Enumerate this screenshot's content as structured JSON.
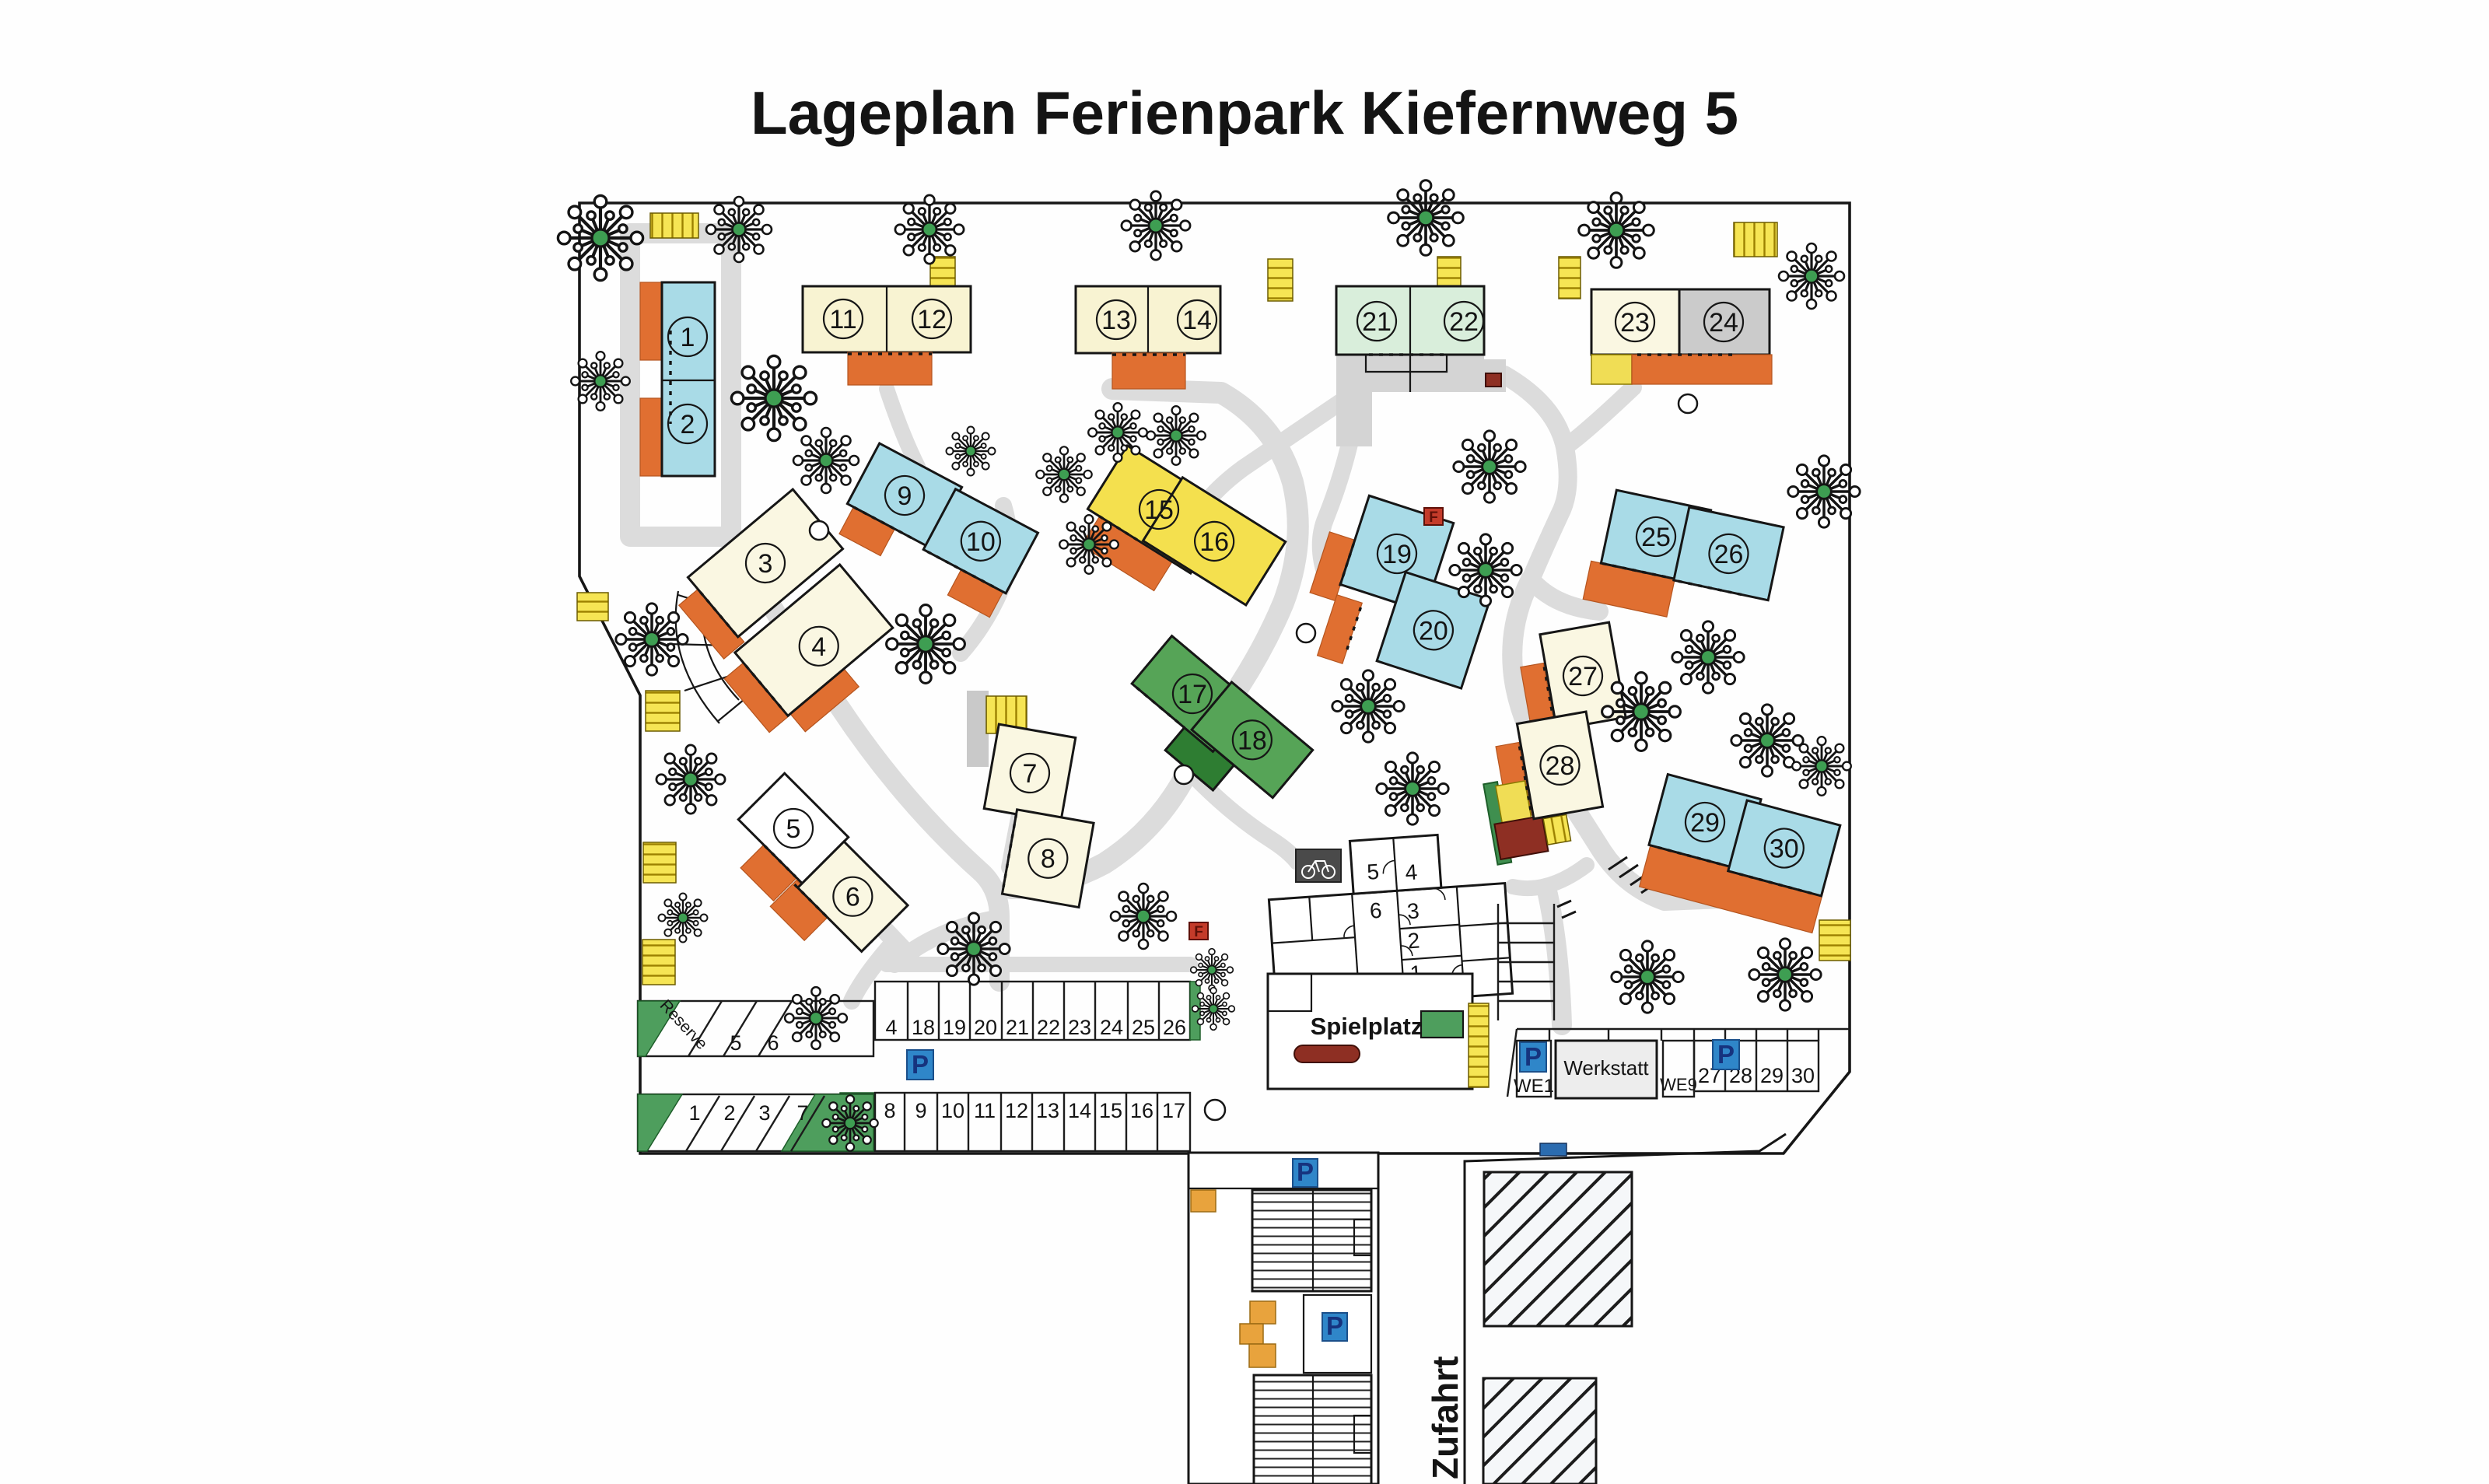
{
  "title": "Lageplan Ferienpark Kiefernweg  5",
  "houses": [
    "1",
    "2",
    "3",
    "4",
    "5",
    "6",
    "7",
    "8",
    "9",
    "10",
    "11",
    "12",
    "13",
    "14",
    "15",
    "16",
    "17",
    "18",
    "19",
    "20",
    "21",
    "22",
    "23",
    "24",
    "25",
    "26",
    "27",
    "28",
    "29",
    "30"
  ],
  "central_units": [
    "1",
    "2",
    "3",
    "4",
    "5",
    "6"
  ],
  "labels": {
    "playground": "Spielplatz",
    "workshop": "Werkstatt",
    "driveway": "Zufahrt",
    "reserve": "Reserve",
    "parking_sign": "P",
    "hydrant": "F"
  },
  "parking": {
    "row_north": [
      "4",
      "18",
      "19",
      "20",
      "21",
      "22",
      "23",
      "24",
      "25",
      "26"
    ],
    "row_south": [
      "8",
      "9",
      "10",
      "11",
      "12",
      "13",
      "14",
      "15",
      "16",
      "17"
    ],
    "row_west_upper": [
      "5",
      "6"
    ],
    "row_west_lower": [
      "1",
      "2",
      "3",
      "7"
    ],
    "row_workshop": [
      "WE1",
      "WE9",
      "27",
      "28",
      "29",
      "30"
    ]
  },
  "colors": {
    "title_blue": "#2a6db5",
    "house_blue": "#a9dbe7",
    "house_cream": "#faf7e2",
    "house_pale_yellow": "#f8f3d2",
    "house_yellow": "#f4e04e",
    "house_green": "#56a457",
    "house_pale_green": "#d9eedb",
    "house_gray": "#cbcbcb",
    "terrace_orange": "#e06f31",
    "path_gray": "#dcdcdc",
    "parking_blue": "#2f86c9",
    "tree_green": "#3e9e52",
    "dark_red": "#8e2f23"
  }
}
